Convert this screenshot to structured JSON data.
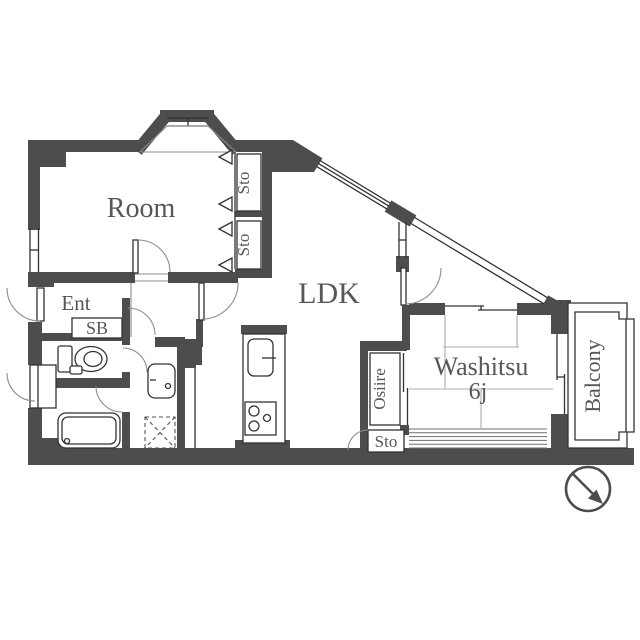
{
  "title": "Apartment floor plan",
  "rooms": {
    "room": {
      "label": "Room"
    },
    "ldk": {
      "label": "LDK"
    },
    "washitsu": {
      "label": "Washitsu",
      "size": "6j"
    },
    "balcony": {
      "label": "Balcony"
    },
    "entrance": {
      "label": "Ent"
    },
    "shoe_box": {
      "label": "SB"
    },
    "storage_room_upper": {
      "label": "Sto"
    },
    "storage_room_lower": {
      "label": "Sto"
    },
    "storage_ldk": {
      "label": "Sto"
    },
    "osiire": {
      "label": "Osiire"
    }
  },
  "icons": {
    "compass": "north-arrow-circle",
    "fixtures": [
      "bathtub",
      "toilet",
      "washbasin",
      "washing-machine-space",
      "kitchen-sink",
      "stove-burners",
      "meter-box"
    ]
  },
  "colors": {
    "wall": "#4d4d4d",
    "line": "#333333",
    "label_text": "#575757",
    "tatami_line": "#ababab",
    "background": "#ffffff"
  }
}
